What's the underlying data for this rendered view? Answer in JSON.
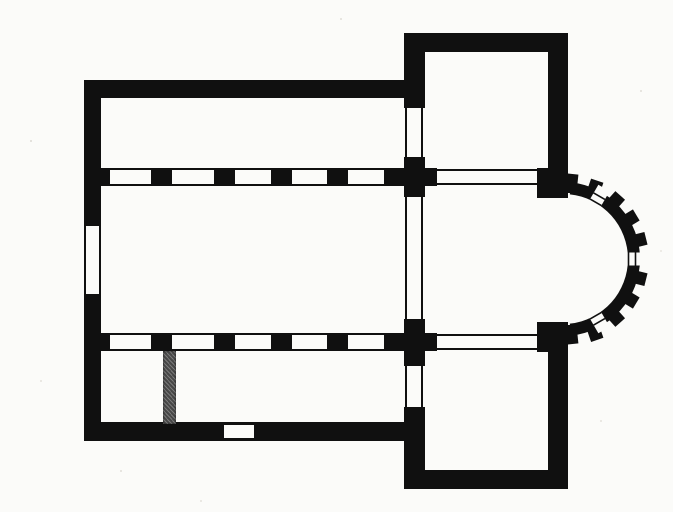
{
  "figure": {
    "title": "Romanesque basilica ground plan",
    "type": "architectural-floor-plan",
    "description": "Printed black-and-white ground plan of a basilica church: a nave flanked by north and south aisles separated by pier arcades of five bays, a west portal in the left wall, a projecting transept with north and south arms, a crossing, and a semicircular apse to the east ringed by buttresses and pierced by three windows. A grey partition wall closes off a small room at the west end of the south aisle, and a doorway niche sits in the south wall.",
    "orientation": "east to the right",
    "colors": {
      "paper": "#fbfbf9",
      "ink": "#101010",
      "partition": "#474747"
    },
    "rooms": [
      "north aisle",
      "nave",
      "south aisle",
      "southwest room",
      "north transept arm",
      "crossing",
      "south transept arm",
      "apse"
    ],
    "counts": {
      "arcade_rows": 2,
      "arcade_piers_per_row": 5,
      "apse_buttresses": 10,
      "apse_windows": 3,
      "wall_openings": 6
    }
  }
}
